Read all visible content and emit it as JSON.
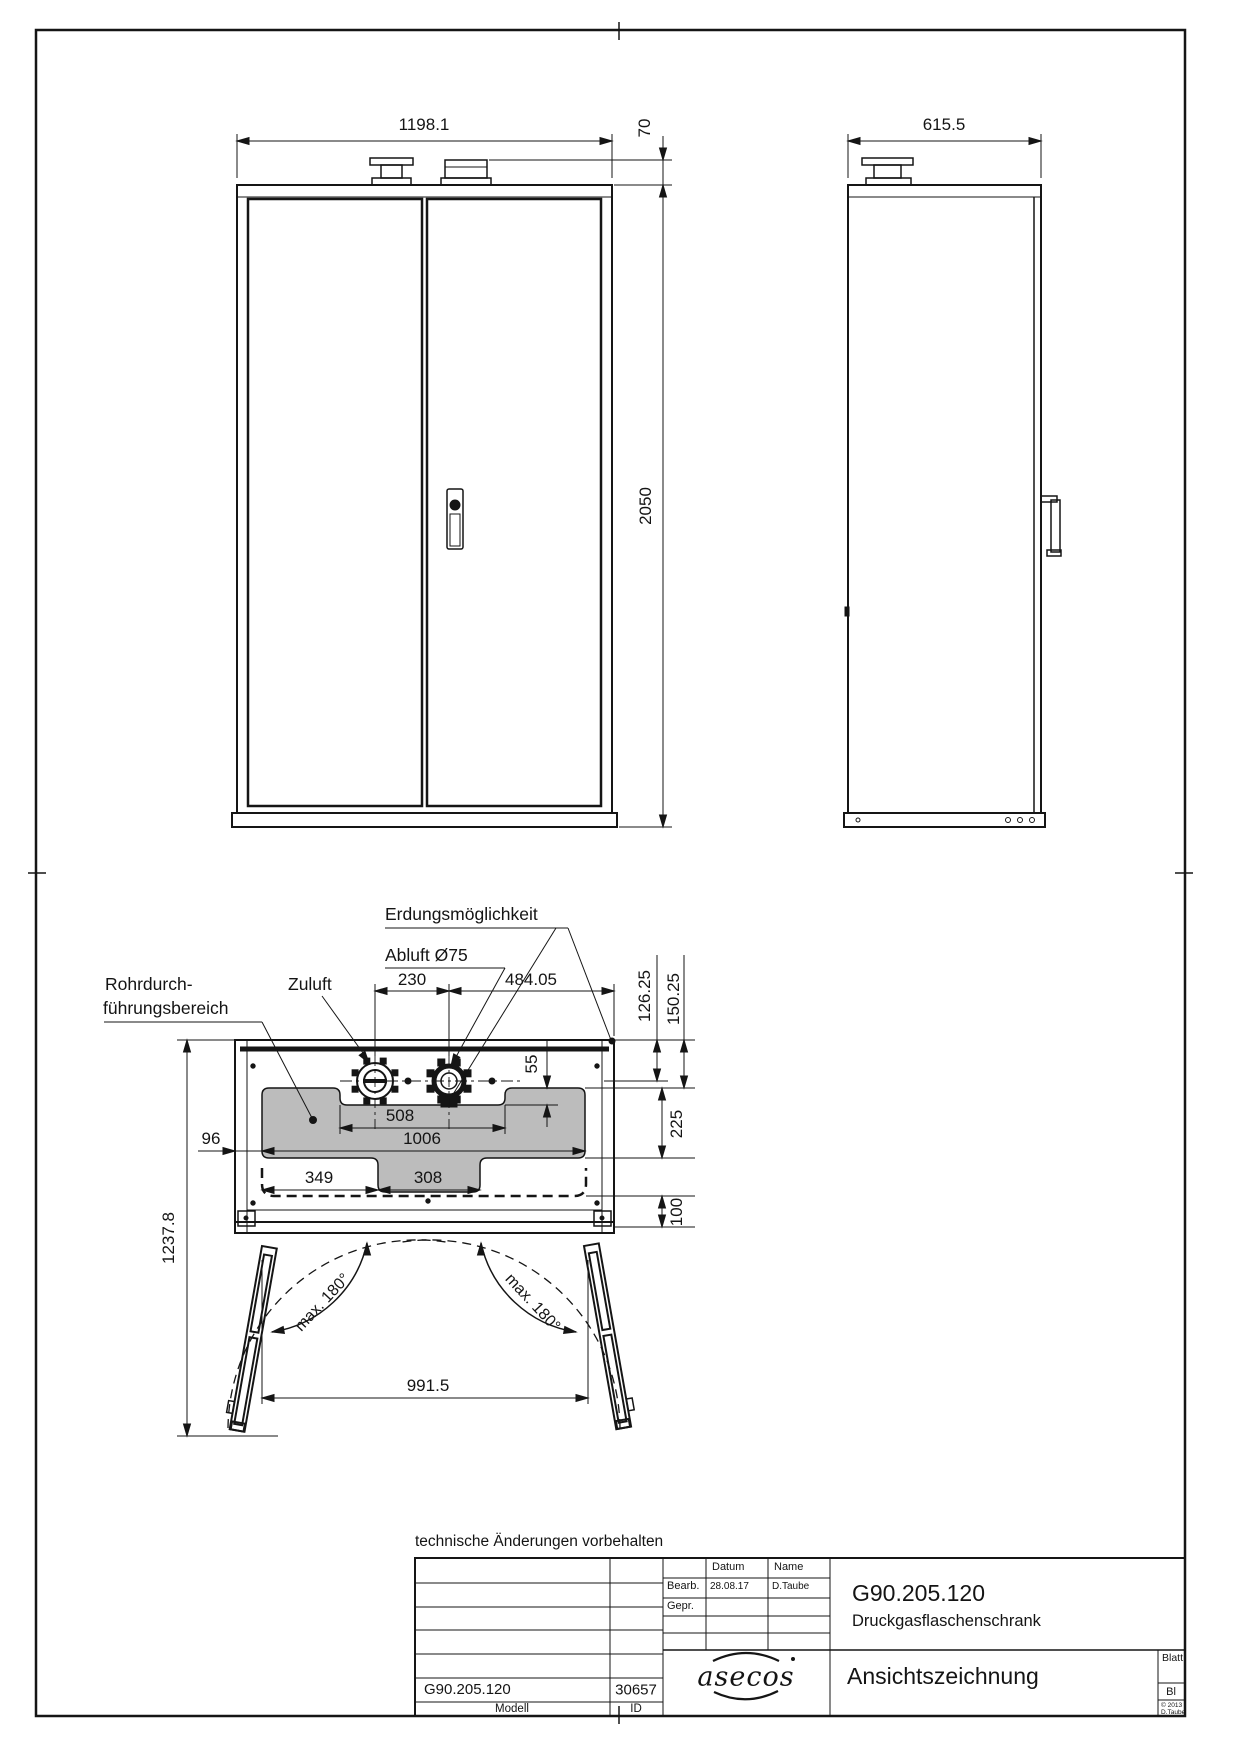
{
  "front_view": {
    "width_dim": "1198.1",
    "fitting_height_dim": "70",
    "height_dim": "2050"
  },
  "side_view": {
    "depth_dim": "615.5"
  },
  "plan_view": {
    "labels": {
      "grounding": "Erdungsmöglichkeit",
      "exhaust": "Abluft Ø75",
      "supply": "Zuluft",
      "pipe_area_line1": "Rohrdurch-",
      "pipe_area_line2": "führungsbereich",
      "door_swing_left": "max. 180°",
      "door_swing_right": "max. 180°"
    },
    "dims": {
      "duct_spacing": "230",
      "duct_to_edge": "484.05",
      "back_to_centerline": "126.25",
      "back_to_area": "150.25",
      "area_step": "55",
      "cutout_width": "508",
      "area_width": "1006",
      "left_margin": "96",
      "cutout_left": "349",
      "cutout_mid": "308",
      "center_to_front": "225",
      "front_zone": "100",
      "total_depth": "1237.8",
      "door_opening": "991.5"
    }
  },
  "footer_note": "technische Änderungen vorbehalten",
  "title_block": {
    "date_label": "Datum",
    "name_label": "Name",
    "created_label": "Bearb.",
    "created_date": "28.08.17",
    "created_by": "D.Taube",
    "checked_label": "Gepr.",
    "model_number": "G90.205.120",
    "product_name": "Druckgasflaschenschrank",
    "logo_text": "asecos",
    "drawing_type": "Ansichtszeichnung",
    "sheet_label": "Blatt",
    "sheet_value": "Bl",
    "copyright_line1": "© 2013",
    "copyright_line2": "D.Taube",
    "model_value": "G90.205.120",
    "id_value": "30657",
    "model_label": "Modell",
    "id_label": "ID"
  }
}
